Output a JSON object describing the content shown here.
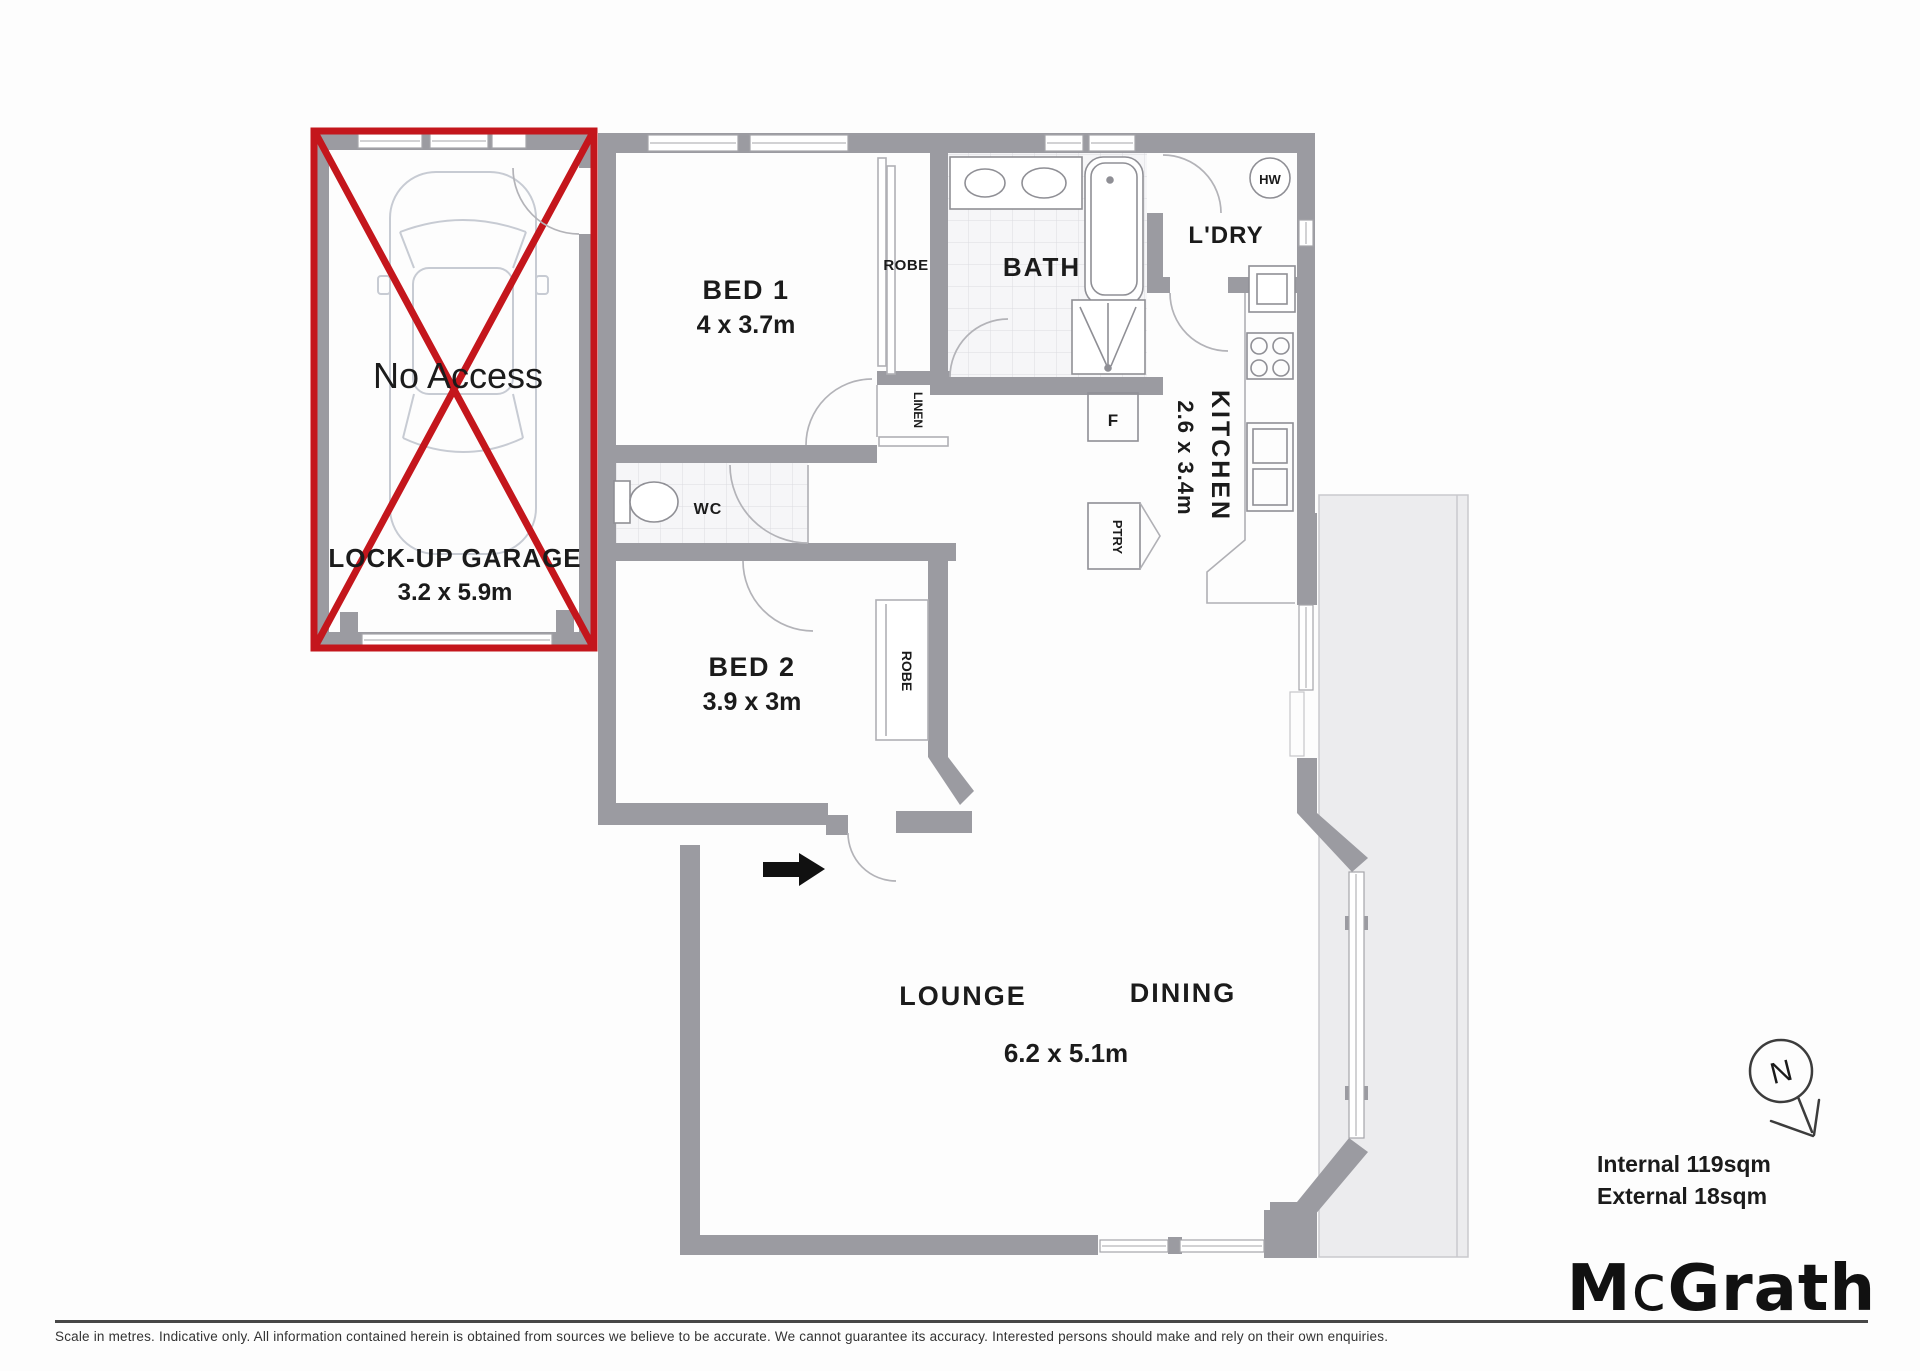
{
  "garage": {
    "no_access": "No Access",
    "name": "LOCK-UP GARAGE",
    "dims": "3.2 x 5.9m"
  },
  "rooms": {
    "bed1": {
      "name": "BED 1",
      "dims": "4 x 3.7m"
    },
    "bath": {
      "name": "BATH"
    },
    "ldry": {
      "name": "L'DRY"
    },
    "kitchen": {
      "name": "KITCHEN",
      "dims": "2.6 x 3.4m"
    },
    "wc": {
      "name": "WC"
    },
    "bed2": {
      "name": "BED 2",
      "dims": "3.9 x 3m"
    },
    "lounge": {
      "name": "LOUNGE"
    },
    "dining": {
      "name": "DINING"
    },
    "lounge_dining": {
      "dims": "6.2 x 5.1m"
    }
  },
  "closets": {
    "robe1": "ROBE",
    "linen": "LINEN",
    "robe2": "ROBE",
    "fridge": "F",
    "pantry": "PTRY",
    "hot_water": "HW"
  },
  "compass": {
    "north": "N"
  },
  "areas": {
    "internal": "Internal 119sqm",
    "external": "External 18sqm"
  },
  "brand": {
    "m": "M",
    "c": "c",
    "grath": "Grath"
  },
  "footer": {
    "disclaimer": "Scale in metres. Indicative only. All information contained herein is obtained from sources we believe to be accurate. We cannot guarantee its accuracy. Interested persons should make and rely on their own enquiries."
  },
  "colors": {
    "wall": "#9b9ba1",
    "accent_red": "#c4161c",
    "external_fill": "#ececee"
  }
}
